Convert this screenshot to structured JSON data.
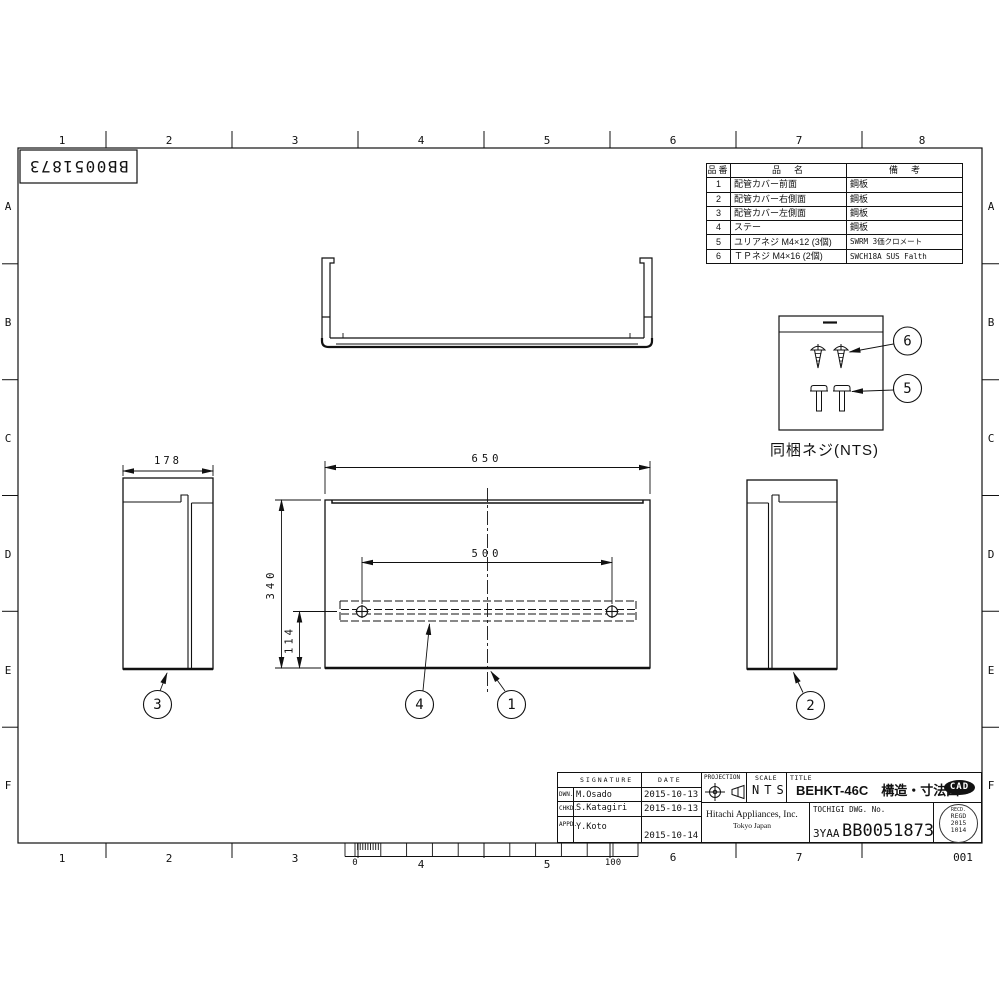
{
  "page": {
    "doc_number_rotated": "BB0051873",
    "sheet_number": "001"
  },
  "border": {
    "top_cols": [
      "1",
      "2",
      "3",
      "4",
      "5",
      "6",
      "7",
      "8"
    ],
    "bottom_cols": [
      "1",
      "2",
      "3",
      "4",
      "5",
      "6",
      "7"
    ],
    "left_rows": [
      "A",
      "B",
      "C",
      "D",
      "E",
      "F"
    ],
    "right_rows": [
      "A",
      "B",
      "C",
      "D",
      "E",
      "F"
    ]
  },
  "parts_table": {
    "headers": [
      "品番",
      "品　名",
      "備　考"
    ],
    "rows": [
      {
        "no": "1",
        "name": "配管カバー前面",
        "remark": "鋼板"
      },
      {
        "no": "2",
        "name": "配管カバー右側面",
        "remark": "鋼板"
      },
      {
        "no": "3",
        "name": "配管カバー左側面",
        "remark": "鋼板"
      },
      {
        "no": "4",
        "name": "ステー",
        "remark": "鋼板"
      },
      {
        "no": "5",
        "name": "ユリアネジ M4×12 (3個)",
        "remark": "SWRM 3価クロメート"
      },
      {
        "no": "6",
        "name": "ＴＰネジ M4×16 (2個)",
        "remark": "SWCH18A SUS Falth"
      }
    ]
  },
  "screw_box": {
    "label": "同梱ネジ(NTS)"
  },
  "balloons": {
    "b1": "1",
    "b2": "2",
    "b3": "3",
    "b4": "4",
    "b5": "5",
    "b6": "6"
  },
  "dims": {
    "front_width": "650",
    "stay_pitch": "500",
    "front_height": "340",
    "stay_height": "114",
    "side_width": "178"
  },
  "ruler": {
    "zero": "0",
    "hundred": "100"
  },
  "title_block": {
    "signature_header": "SIGNATURE",
    "date_header": "DATE",
    "rows": [
      {
        "role": "DWN.",
        "name": "M.Osado",
        "date": "2015-10-13"
      },
      {
        "role": "CHKD.",
        "name": "S.Katagiri",
        "date": "2015-10-13"
      },
      {
        "role": "APPD.",
        "name": "Y.Koto",
        "date": "2015-10-14"
      }
    ],
    "projection_label": "PROJECTION",
    "scale_label": "SCALE",
    "scale_value": "NTS",
    "title_label": "TITLE",
    "title_value": "BEHKT-46C　構造・寸法図",
    "cad_mark": "CAD",
    "company_name": "Hitachi Appliances, Inc.",
    "company_city": "Tokyo Japan",
    "dwg_no_label": "TOCHIGI DWG. No.",
    "dwg_prefix": "3YAA",
    "dwg_number": "BB0051873",
    "stamp": {
      "recd": "RECD.",
      "regd": "REGD",
      "year": "2015",
      "monthday": "1014"
    }
  }
}
